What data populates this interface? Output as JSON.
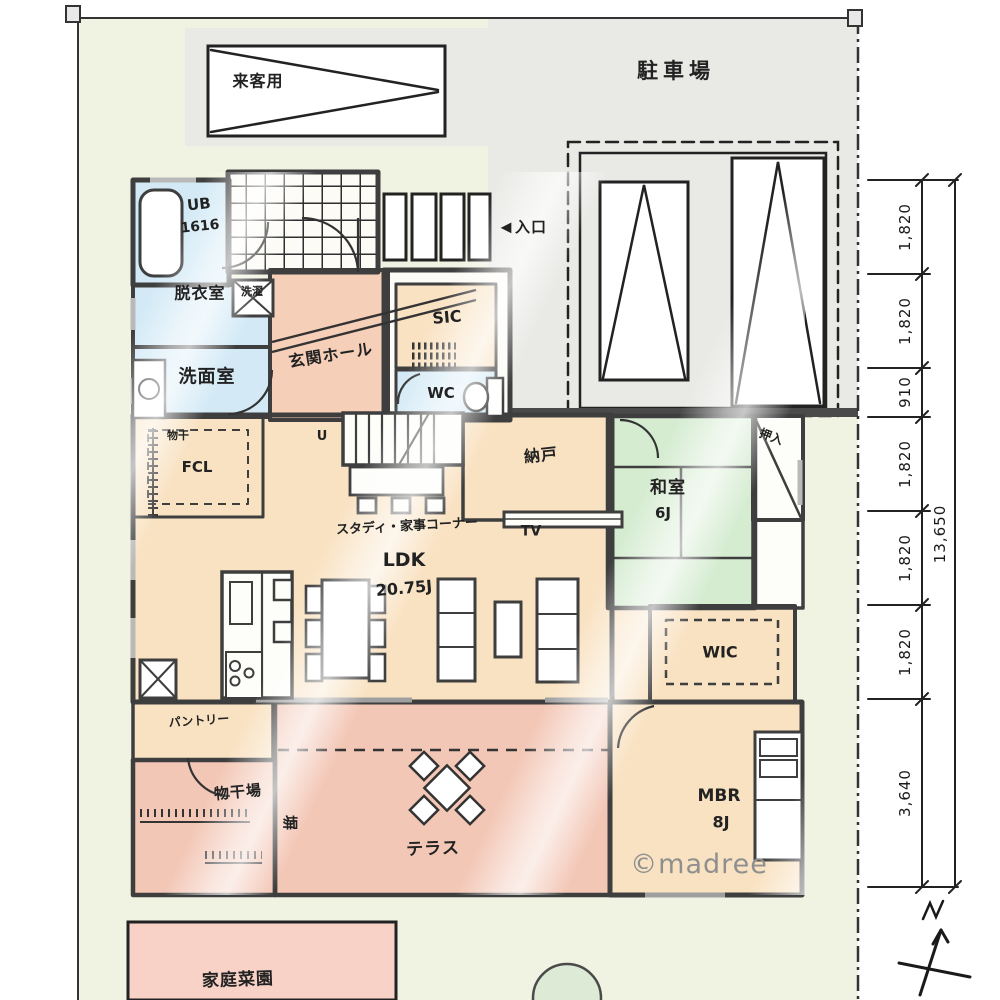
{
  "site": {
    "parking_lot": "駐車場",
    "visitor_parking": "来客用",
    "entrance_arrow": "◀",
    "entrance": "入口",
    "fence": "塀",
    "garden": "家庭菜園",
    "watermark": "©madree"
  },
  "rooms": {
    "bath": {
      "name": "UB",
      "size": "1616"
    },
    "dressing_room": "脱衣室",
    "washer": "洗濯",
    "washroom": "洗面室",
    "family_closet": "FCL",
    "drying_pole": "物干",
    "entrance_hall": "玄関ホール",
    "shoe_closet": "SIC",
    "toilet": "WC",
    "stairs_up": "U",
    "study_corner": "スタディ・家事コーナー",
    "storage": "納戸",
    "tv": "TV",
    "japanese_room": {
      "name": "和室",
      "size": "6J"
    },
    "oshiire": "押入",
    "walk_in_closet": "WIC",
    "master_bedroom": {
      "name": "MBR",
      "size": "8J"
    },
    "ldk": {
      "name": "LDK",
      "size": "20.75J"
    },
    "pantry": "パントリー",
    "drying_area": "物干場",
    "terrace": "テラス"
  },
  "dimensions": {
    "segments": [
      "1,820",
      "1,820",
      "910",
      "1,820",
      "1,820",
      "1,820",
      "3,640"
    ],
    "total": "13,650"
  }
}
